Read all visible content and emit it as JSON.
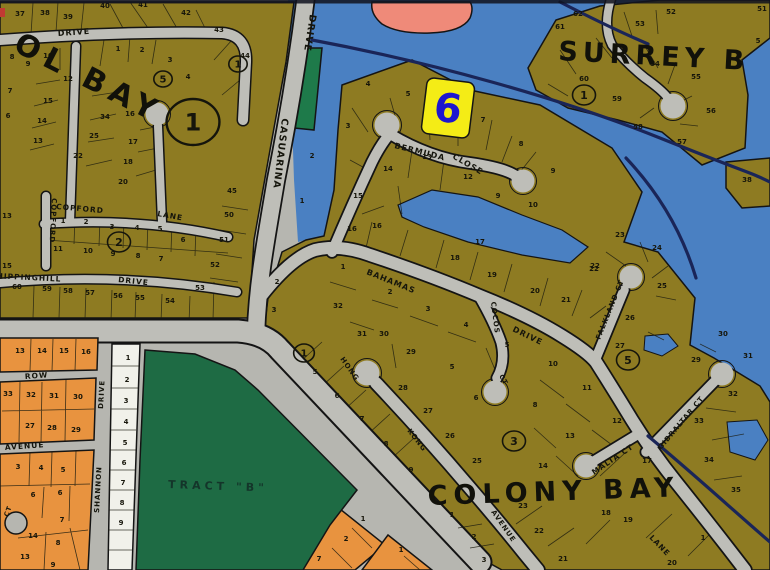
{
  "map": {
    "title": "subdivision plat map",
    "marker": {
      "label": "6"
    },
    "colors": {
      "water": "#4a80c2",
      "land_olive": "#8e7b22",
      "road_gray": "#bebeb8",
      "green_tract": "#1e6b44",
      "orange_lots": "#e8933f",
      "white_lots": "#f1f1ea",
      "marker_yellow": "#f4ec16",
      "marker_blue": "#1d16cf",
      "channel_navy": "#1a2558",
      "salmon": "#ef8a79"
    },
    "areas": [
      {
        "name": "OL BAY",
        "x": 12,
        "y": 50,
        "rot": 27,
        "size": 30,
        "ls": 7,
        "color": "#11110a"
      },
      {
        "name": "SURREY B",
        "x": 558,
        "y": 60,
        "rot": 3,
        "size": 27,
        "ls": 5,
        "color": "#11110a"
      },
      {
        "name": "COLONY BAY",
        "x": 428,
        "y": 505,
        "rot": -2,
        "size": 27,
        "ls": 6,
        "color": "#11110a"
      },
      {
        "name": "TRACT \"B\"",
        "x": 168,
        "y": 488,
        "rot": 2,
        "size": 11,
        "ls": 4,
        "color": "#14352a"
      }
    ],
    "streets": [
      {
        "name": "DRIVE",
        "x": 58,
        "y": 36,
        "rot": -4,
        "size": 8
      },
      {
        "name": "CASUARINA",
        "x": 282,
        "y": 118,
        "rot": 97,
        "size": 9.5
      },
      {
        "name": "DRIVE",
        "x": 310,
        "y": 14,
        "rot": 99,
        "size": 9.5
      },
      {
        "name": "COPFORD",
        "x": 56,
        "y": 209,
        "rot": 5,
        "size": 7.5
      },
      {
        "name": "LANE",
        "x": 157,
        "y": 216,
        "rot": 10,
        "size": 7.5
      },
      {
        "name": "COPFORD",
        "x": 52,
        "y": 198,
        "rot": 93,
        "size": 7
      },
      {
        "name": "CHIPPINGHILL",
        "x": -10,
        "y": 278,
        "rot": 3,
        "size": 7.5
      },
      {
        "name": "DRIVE",
        "x": 118,
        "y": 282,
        "rot": 6,
        "size": 7.5
      },
      {
        "name": "ROW",
        "x": 25,
        "y": 379,
        "rot": -4,
        "size": 7.5
      },
      {
        "name": "AVENUE",
        "x": 5,
        "y": 450,
        "rot": -4,
        "size": 7.5
      },
      {
        "name": "CT",
        "x": 8,
        "y": 517,
        "rot": -70,
        "size": 6.5
      },
      {
        "name": "SHANNON",
        "x": 99,
        "y": 513,
        "rot": -87,
        "size": 7
      },
      {
        "name": "DRIVE",
        "x": 103,
        "y": 409,
        "rot": -87,
        "size": 7
      },
      {
        "name": "BERMUDA",
        "x": 394,
        "y": 148,
        "rot": 14,
        "size": 8
      },
      {
        "name": "CLOSE",
        "x": 452,
        "y": 158,
        "rot": 30,
        "size": 8
      },
      {
        "name": "BAHAMAS",
        "x": 366,
        "y": 274,
        "rot": 22,
        "size": 8
      },
      {
        "name": "DRIVE",
        "x": 512,
        "y": 331,
        "rot": 26,
        "size": 8
      },
      {
        "name": "COCOS",
        "x": 491,
        "y": 302,
        "rot": 83,
        "size": 7
      },
      {
        "name": "CT",
        "x": 499,
        "y": 376,
        "rot": 60,
        "size": 6.5
      },
      {
        "name": "FALKLAND CT",
        "x": 600,
        "y": 340,
        "rot": -68,
        "size": 7
      },
      {
        "name": "HONG",
        "x": 340,
        "y": 359,
        "rot": 55,
        "size": 7
      },
      {
        "name": "KONG",
        "x": 407,
        "y": 431,
        "rot": 52,
        "size": 7
      },
      {
        "name": "AVENUE",
        "x": 491,
        "y": 512,
        "rot": 55,
        "size": 7
      },
      {
        "name": "MALTA CT",
        "x": 594,
        "y": 475,
        "rot": -34,
        "size": 7.5
      },
      {
        "name": "GIBRALTAR CT",
        "x": 661,
        "y": 450,
        "rot": -50,
        "size": 7
      },
      {
        "name": "LANE",
        "x": 649,
        "y": 538,
        "rot": 46,
        "size": 7.5
      }
    ],
    "section_markers": [
      {
        "n": "1",
        "x": 193,
        "y": 122,
        "r": 23,
        "fs": 24
      },
      {
        "n": "5",
        "x": 163,
        "y": 79,
        "r": 8,
        "fs": 10
      },
      {
        "n": "1",
        "x": 238,
        "y": 64,
        "r": 8,
        "fs": 10
      },
      {
        "n": "2",
        "x": 119,
        "y": 242,
        "r": 10,
        "fs": 11
      },
      {
        "n": "1",
        "x": 304,
        "y": 353,
        "r": 9,
        "fs": 10
      },
      {
        "n": "3",
        "x": 514,
        "y": 441,
        "r": 10,
        "fs": 11
      },
      {
        "n": "5",
        "x": 628,
        "y": 360,
        "r": 10,
        "fs": 11
      },
      {
        "n": "1",
        "x": 584,
        "y": 95,
        "r": 10,
        "fs": 11
      }
    ],
    "lots": [
      {
        "n": "37",
        "x": 20,
        "y": 16
      },
      {
        "n": "38",
        "x": 45,
        "y": 15
      },
      {
        "n": "39",
        "x": 68,
        "y": 19
      },
      {
        "n": "40",
        "x": 105,
        "y": 8
      },
      {
        "n": "41",
        "x": 143,
        "y": 7
      },
      {
        "n": "42",
        "x": 186,
        "y": 15
      },
      {
        "n": "43",
        "x": 219,
        "y": 32
      },
      {
        "n": "44",
        "x": 245,
        "y": 58
      },
      {
        "n": "45",
        "x": 232,
        "y": 193
      },
      {
        "n": "50",
        "x": 229,
        "y": 217
      },
      {
        "n": "51",
        "x": 224,
        "y": 242
      },
      {
        "n": "52",
        "x": 215,
        "y": 267
      },
      {
        "n": "53",
        "x": 200,
        "y": 290
      },
      {
        "n": "1",
        "x": 118,
        "y": 51
      },
      {
        "n": "2",
        "x": 142,
        "y": 52
      },
      {
        "n": "3",
        "x": 170,
        "y": 62
      },
      {
        "n": "4",
        "x": 188,
        "y": 79
      },
      {
        "n": "10",
        "x": 48,
        "y": 58
      },
      {
        "n": "9",
        "x": 28,
        "y": 66
      },
      {
        "n": "8",
        "x": 12,
        "y": 59
      },
      {
        "n": "12",
        "x": 68,
        "y": 81
      },
      {
        "n": "15",
        "x": 48,
        "y": 103
      },
      {
        "n": "14",
        "x": 42,
        "y": 123
      },
      {
        "n": "13",
        "x": 38,
        "y": 143
      },
      {
        "n": "16",
        "x": 130,
        "y": 116
      },
      {
        "n": "34",
        "x": 105,
        "y": 119
      },
      {
        "n": "25",
        "x": 94,
        "y": 138
      },
      {
        "n": "22",
        "x": 78,
        "y": 158
      },
      {
        "n": "17",
        "x": 133,
        "y": 144
      },
      {
        "n": "18",
        "x": 128,
        "y": 164
      },
      {
        "n": "20",
        "x": 123,
        "y": 184
      },
      {
        "n": "7",
        "x": 10,
        "y": 93
      },
      {
        "n": "6",
        "x": 8,
        "y": 118
      },
      {
        "n": "13",
        "x": 7,
        "y": 218
      },
      {
        "n": "15",
        "x": 7,
        "y": 268
      },
      {
        "n": "1",
        "x": 63,
        "y": 223
      },
      {
        "n": "2",
        "x": 86,
        "y": 224
      },
      {
        "n": "3",
        "x": 112,
        "y": 229
      },
      {
        "n": "4",
        "x": 137,
        "y": 230
      },
      {
        "n": "5",
        "x": 160,
        "y": 231
      },
      {
        "n": "6",
        "x": 183,
        "y": 242
      },
      {
        "n": "11",
        "x": 58,
        "y": 251
      },
      {
        "n": "10",
        "x": 88,
        "y": 253
      },
      {
        "n": "9",
        "x": 113,
        "y": 256
      },
      {
        "n": "8",
        "x": 138,
        "y": 258
      },
      {
        "n": "7",
        "x": 161,
        "y": 261
      },
      {
        "n": "60",
        "x": 17,
        "y": 289
      },
      {
        "n": "59",
        "x": 47,
        "y": 291
      },
      {
        "n": "58",
        "x": 68,
        "y": 293
      },
      {
        "n": "57",
        "x": 90,
        "y": 295
      },
      {
        "n": "56",
        "x": 118,
        "y": 298
      },
      {
        "n": "55",
        "x": 140,
        "y": 300
      },
      {
        "n": "54",
        "x": 170,
        "y": 303
      },
      {
        "n": "2",
        "x": 312,
        "y": 158
      },
      {
        "n": "3",
        "x": 348,
        "y": 128
      },
      {
        "n": "4",
        "x": 368,
        "y": 86
      },
      {
        "n": "5",
        "x": 408,
        "y": 96
      },
      {
        "n": "7",
        "x": 483,
        "y": 122
      },
      {
        "n": "8",
        "x": 521,
        "y": 146
      },
      {
        "n": "9",
        "x": 498,
        "y": 198
      },
      {
        "n": "10",
        "x": 533,
        "y": 207
      },
      {
        "n": "13",
        "x": 427,
        "y": 159
      },
      {
        "n": "12",
        "x": 468,
        "y": 179
      },
      {
        "n": "14",
        "x": 388,
        "y": 171
      },
      {
        "n": "15",
        "x": 358,
        "y": 198
      },
      {
        "n": "16",
        "x": 377,
        "y": 228
      },
      {
        "n": "1",
        "x": 302,
        "y": 203
      },
      {
        "n": "62",
        "x": 578,
        "y": 16
      },
      {
        "n": "61",
        "x": 560,
        "y": 29
      },
      {
        "n": "53",
        "x": 640,
        "y": 26
      },
      {
        "n": "52",
        "x": 671,
        "y": 14
      },
      {
        "n": "51",
        "x": 762,
        "y": 11
      },
      {
        "n": "54",
        "x": 655,
        "y": 66
      },
      {
        "n": "55",
        "x": 696,
        "y": 79
      },
      {
        "n": "56",
        "x": 711,
        "y": 113
      },
      {
        "n": "57",
        "x": 682,
        "y": 144
      },
      {
        "n": "58",
        "x": 638,
        "y": 129
      },
      {
        "n": "59",
        "x": 617,
        "y": 101
      },
      {
        "n": "60",
        "x": 584,
        "y": 81
      },
      {
        "n": "5",
        "x": 758,
        "y": 43
      },
      {
        "n": "38",
        "x": 747,
        "y": 182
      },
      {
        "n": "9",
        "x": 553,
        "y": 173
      },
      {
        "n": "16",
        "x": 352,
        "y": 231
      },
      {
        "n": "17",
        "x": 480,
        "y": 244
      },
      {
        "n": "18",
        "x": 455,
        "y": 260
      },
      {
        "n": "19",
        "x": 492,
        "y": 277
      },
      {
        "n": "20",
        "x": 535,
        "y": 293
      },
      {
        "n": "21",
        "x": 566,
        "y": 302
      },
      {
        "n": "22",
        "x": 594,
        "y": 271
      },
      {
        "n": "1",
        "x": 343,
        "y": 269
      },
      {
        "n": "2",
        "x": 390,
        "y": 294
      },
      {
        "n": "3",
        "x": 428,
        "y": 311
      },
      {
        "n": "4",
        "x": 466,
        "y": 327
      },
      {
        "n": "5",
        "x": 507,
        "y": 347
      },
      {
        "n": "32",
        "x": 338,
        "y": 308
      },
      {
        "n": "31",
        "x": 362,
        "y": 336
      },
      {
        "n": "30",
        "x": 384,
        "y": 336
      },
      {
        "n": "29",
        "x": 411,
        "y": 354
      },
      {
        "n": "2",
        "x": 277,
        "y": 284
      },
      {
        "n": "3",
        "x": 274,
        "y": 312
      },
      {
        "n": "6",
        "x": 476,
        "y": 400
      },
      {
        "n": "28",
        "x": 403,
        "y": 390
      },
      {
        "n": "27",
        "x": 428,
        "y": 413
      },
      {
        "n": "26",
        "x": 450,
        "y": 438
      },
      {
        "n": "25",
        "x": 477,
        "y": 463
      },
      {
        "n": "5",
        "x": 452,
        "y": 369
      },
      {
        "n": "5",
        "x": 315,
        "y": 374
      },
      {
        "n": "6",
        "x": 337,
        "y": 398
      },
      {
        "n": "7",
        "x": 362,
        "y": 421
      },
      {
        "n": "8",
        "x": 386,
        "y": 446
      },
      {
        "n": "9",
        "x": 411,
        "y": 472
      },
      {
        "n": "22",
        "x": 595,
        "y": 268
      },
      {
        "n": "23",
        "x": 620,
        "y": 237
      },
      {
        "n": "24",
        "x": 657,
        "y": 250
      },
      {
        "n": "25",
        "x": 662,
        "y": 288
      },
      {
        "n": "26",
        "x": 630,
        "y": 320
      },
      {
        "n": "27",
        "x": 620,
        "y": 348
      },
      {
        "n": "29",
        "x": 696,
        "y": 362
      },
      {
        "n": "30",
        "x": 723,
        "y": 336
      },
      {
        "n": "31",
        "x": 748,
        "y": 358
      },
      {
        "n": "10",
        "x": 553,
        "y": 366
      },
      {
        "n": "11",
        "x": 587,
        "y": 390
      },
      {
        "n": "8",
        "x": 535,
        "y": 407
      },
      {
        "n": "12",
        "x": 617,
        "y": 423
      },
      {
        "n": "13",
        "x": 570,
        "y": 438
      },
      {
        "n": "14",
        "x": 543,
        "y": 468
      },
      {
        "n": "17",
        "x": 647,
        "y": 463
      },
      {
        "n": "18",
        "x": 606,
        "y": 515
      },
      {
        "n": "19",
        "x": 628,
        "y": 522
      },
      {
        "n": "23",
        "x": 523,
        "y": 508
      },
      {
        "n": "22",
        "x": 539,
        "y": 533
      },
      {
        "n": "21",
        "x": 563,
        "y": 561
      },
      {
        "n": "20",
        "x": 672,
        "y": 565
      },
      {
        "n": "1",
        "x": 703,
        "y": 540
      },
      {
        "n": "32",
        "x": 733,
        "y": 396
      },
      {
        "n": "33",
        "x": 699,
        "y": 423
      },
      {
        "n": "34",
        "x": 709,
        "y": 462
      },
      {
        "n": "35",
        "x": 736,
        "y": 492
      },
      {
        "n": "1",
        "x": 452,
        "y": 517
      },
      {
        "n": "2",
        "x": 474,
        "y": 539
      },
      {
        "n": "3",
        "x": 484,
        "y": 562
      },
      {
        "n": "1",
        "x": 363,
        "y": 521
      },
      {
        "n": "2",
        "x": 346,
        "y": 541
      },
      {
        "n": "7",
        "x": 319,
        "y": 561
      },
      {
        "n": "1",
        "x": 401,
        "y": 552
      },
      {
        "n": "1",
        "x": 128,
        "y": 360
      },
      {
        "n": "2",
        "x": 127,
        "y": 382
      },
      {
        "n": "3",
        "x": 126,
        "y": 403
      },
      {
        "n": "4",
        "x": 126,
        "y": 424
      },
      {
        "n": "5",
        "x": 125,
        "y": 445
      },
      {
        "n": "6",
        "x": 124,
        "y": 465
      },
      {
        "n": "7",
        "x": 123,
        "y": 485
      },
      {
        "n": "8",
        "x": 122,
        "y": 505
      },
      {
        "n": "9",
        "x": 121,
        "y": 525
      },
      {
        "n": "13",
        "x": 20,
        "y": 353
      },
      {
        "n": "14",
        "x": 42,
        "y": 353
      },
      {
        "n": "15",
        "x": 64,
        "y": 353
      },
      {
        "n": "16",
        "x": 86,
        "y": 354
      },
      {
        "n": "33",
        "x": 8,
        "y": 396
      },
      {
        "n": "32",
        "x": 31,
        "y": 397
      },
      {
        "n": "31",
        "x": 54,
        "y": 398
      },
      {
        "n": "30",
        "x": 78,
        "y": 399
      },
      {
        "n": "27",
        "x": 30,
        "y": 428
      },
      {
        "n": "28",
        "x": 52,
        "y": 430
      },
      {
        "n": "29",
        "x": 76,
        "y": 432
      },
      {
        "n": "3",
        "x": 18,
        "y": 469
      },
      {
        "n": "4",
        "x": 41,
        "y": 470
      },
      {
        "n": "5",
        "x": 63,
        "y": 472
      },
      {
        "n": "6",
        "x": 33,
        "y": 497
      },
      {
        "n": "6",
        "x": 60,
        "y": 495
      },
      {
        "n": "7",
        "x": 62,
        "y": 522
      },
      {
        "n": "14",
        "x": 33,
        "y": 538
      },
      {
        "n": "8",
        "x": 58,
        "y": 545
      },
      {
        "n": "13",
        "x": 25,
        "y": 559
      },
      {
        "n": "9",
        "x": 53,
        "y": 567
      }
    ]
  }
}
